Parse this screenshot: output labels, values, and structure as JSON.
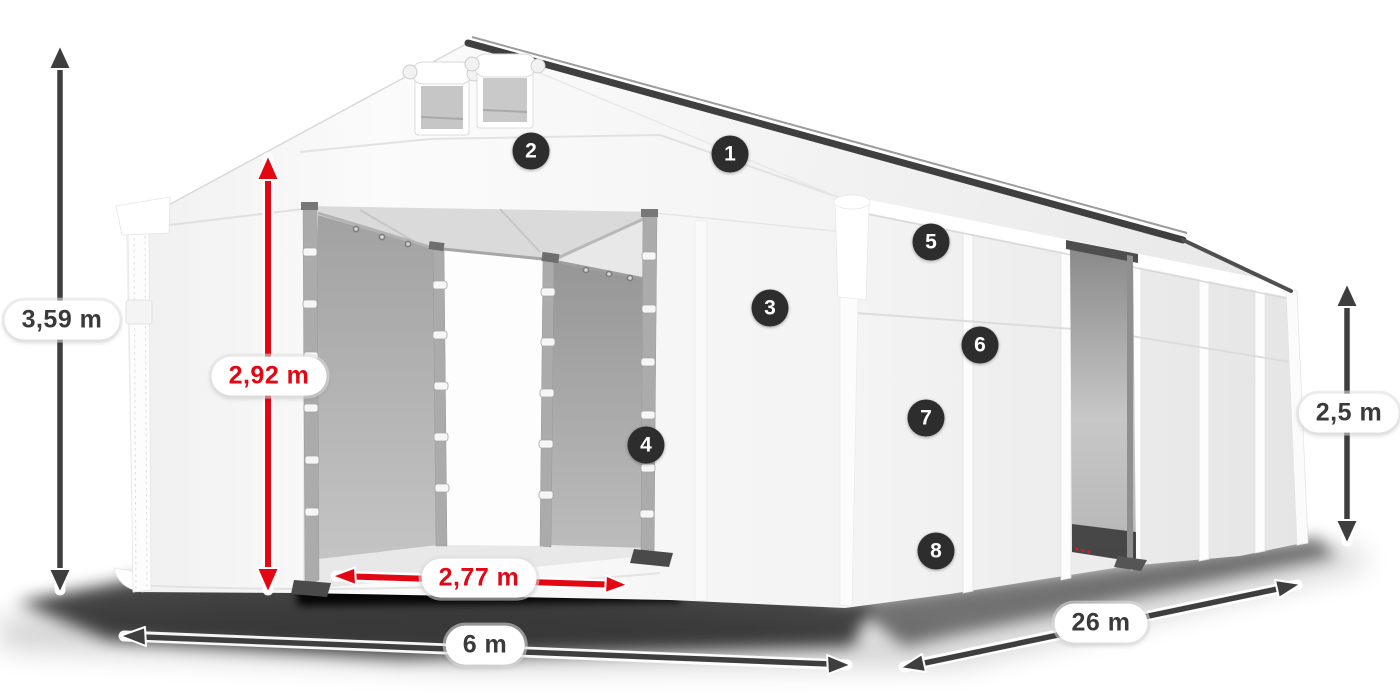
{
  "diagram": {
    "description": "White PVC storage tent hall with gable entrance, shown in perspective with dimension arrows and numbered feature callouts",
    "dimensions": [
      {
        "name": "total-height",
        "label": "3,59 m",
        "style": "dark"
      },
      {
        "name": "entrance-height",
        "label": "2,92 m",
        "style": "red"
      },
      {
        "name": "entrance-width",
        "label": "2,77 m",
        "style": "red"
      },
      {
        "name": "tent-width",
        "label": "6 m",
        "style": "dark"
      },
      {
        "name": "tent-length",
        "label": "26 m",
        "style": "dark"
      },
      {
        "name": "side-height",
        "label": "2,5 m",
        "style": "dark"
      }
    ],
    "callouts": [
      {
        "number": "1"
      },
      {
        "number": "2"
      },
      {
        "number": "3"
      },
      {
        "number": "4"
      },
      {
        "number": "5"
      },
      {
        "number": "6"
      },
      {
        "number": "7"
      },
      {
        "number": "8"
      }
    ]
  },
  "colors": {
    "red": "#e30613",
    "dark": "#3e3e3e",
    "badge": "#2d2d2d",
    "labeltext": "#3a3a3a"
  }
}
